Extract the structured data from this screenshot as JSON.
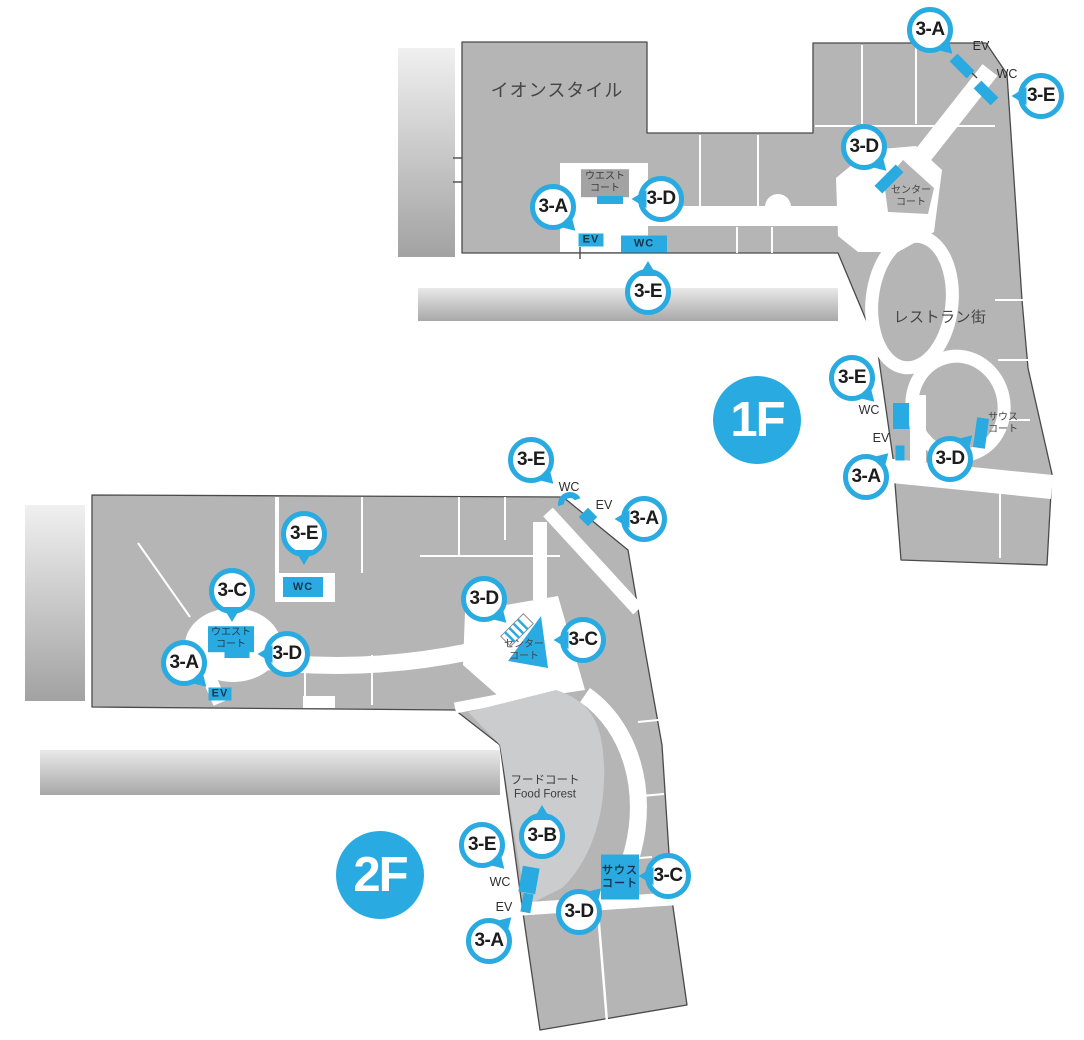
{
  "colors": {
    "accent": "#29abe2",
    "building": "#b5b5b6",
    "building_light": "#cacccd",
    "outline": "#4a4a4a"
  },
  "floors": [
    {
      "name": "1F",
      "badge": {
        "label": "1F"
      },
      "area_labels": [
        {
          "name": "aeon-style-label",
          "text": "イオンスタイル",
          "x": 557,
          "y": 91,
          "cls": "sz-big"
        },
        {
          "name": "west-court-label",
          "lines": [
            "ウエスト",
            "コート"
          ],
          "x": 605,
          "y": 183,
          "cls": "sz-small bg-gray"
        },
        {
          "name": "center-court-label",
          "lines": [
            "センター",
            "コート"
          ],
          "x": 911,
          "y": 197,
          "cls": "sz-small"
        },
        {
          "name": "restaurant-street-label",
          "text": "レストラン街",
          "x": 940,
          "y": 318,
          "cls": "sz-med"
        },
        {
          "name": "south-court-label",
          "lines": [
            "サウス",
            "コート"
          ],
          "x": 1003,
          "y": 424,
          "cls": "sz-small"
        }
      ],
      "markers": [
        {
          "label": "3-A",
          "x": 930,
          "y": 30,
          "tail": "br"
        },
        {
          "label": "3-E",
          "x": 1041,
          "y": 96,
          "tail": "l"
        },
        {
          "label": "3-D",
          "x": 864,
          "y": 147,
          "tail": "br"
        },
        {
          "label": "3-A",
          "x": 553,
          "y": 207,
          "tail": "br"
        },
        {
          "label": "3-D",
          "x": 661,
          "y": 199,
          "tail": "l"
        },
        {
          "label": "3-E",
          "x": 648,
          "y": 292,
          "tail": "t"
        },
        {
          "label": "3-E",
          "x": 852,
          "y": 378,
          "tail": "br"
        },
        {
          "label": "3-A",
          "x": 866,
          "y": 477,
          "tail": "tr"
        },
        {
          "label": "3-D",
          "x": 950,
          "y": 459,
          "tail": "tr"
        }
      ],
      "facilities": [
        {
          "name": "ev-label",
          "kind": "text",
          "label": "EV",
          "x": 981,
          "y": 46
        },
        {
          "name": "elevator-mark",
          "kind": "mark",
          "x": 962,
          "y": 66,
          "w": 24,
          "h": 11,
          "rot": 45
        },
        {
          "name": "wc-label",
          "kind": "text",
          "label": "WC",
          "x": 1007,
          "y": 74
        },
        {
          "name": "toilet-mark",
          "kind": "mark",
          "x": 986,
          "y": 93,
          "w": 24,
          "h": 11,
          "rot": 45
        },
        {
          "name": "escalator-mark",
          "kind": "mark",
          "x": 889,
          "y": 179,
          "w": 30,
          "h": 11,
          "rot": -45
        },
        {
          "name": "escalator-mark",
          "kind": "mark",
          "x": 610,
          "y": 200,
          "w": 26,
          "h": 8,
          "rot": 0
        },
        {
          "name": "ev-sign",
          "kind": "box",
          "label": "EV",
          "x": 591,
          "y": 240,
          "w": 25,
          "h": 13
        },
        {
          "name": "wc-sign",
          "kind": "box",
          "label": "WC",
          "x": 644,
          "y": 244,
          "w": 46,
          "h": 17
        },
        {
          "name": "wc-label",
          "kind": "text",
          "label": "WC",
          "x": 869,
          "y": 410
        },
        {
          "name": "toilet-mark",
          "kind": "mark",
          "x": 901,
          "y": 416,
          "w": 16,
          "h": 26,
          "rot": 0
        },
        {
          "name": "ev-label",
          "kind": "text",
          "label": "EV",
          "x": 881,
          "y": 438
        },
        {
          "name": "elevator-mark",
          "kind": "mark",
          "x": 900,
          "y": 453,
          "w": 9,
          "h": 15,
          "rot": 0
        },
        {
          "name": "escalator-mark",
          "kind": "mark",
          "x": 981,
          "y": 433,
          "w": 12,
          "h": 30,
          "rot": 8
        }
      ]
    },
    {
      "name": "2F",
      "badge": {
        "label": "2F"
      },
      "area_labels": [
        {
          "name": "west-court-label",
          "lines": [
            "ウエスト",
            "コート"
          ],
          "x": 231,
          "y": 639,
          "cls": "sz-small bg-blue"
        },
        {
          "name": "center-court-label",
          "lines": [
            "センター",
            "コート"
          ],
          "x": 524,
          "y": 651,
          "cls": "sz-small"
        },
        {
          "name": "food-court-label",
          "lines": [
            "フードコート",
            "Food Forest"
          ],
          "x": 545,
          "y": 788,
          "cls": "sz-ff"
        }
      ],
      "markers": [
        {
          "label": "3-E",
          "x": 531,
          "y": 460,
          "tail": "br"
        },
        {
          "label": "3-A",
          "x": 644,
          "y": 519,
          "tail": "l"
        },
        {
          "label": "3-E",
          "x": 304,
          "y": 534,
          "tail": "b"
        },
        {
          "label": "3-C",
          "x": 232,
          "y": 591,
          "tail": "b"
        },
        {
          "label": "3-D",
          "x": 287,
          "y": 654,
          "tail": "l"
        },
        {
          "label": "3-A",
          "x": 184,
          "y": 663,
          "tail": "br"
        },
        {
          "label": "3-D",
          "x": 484,
          "y": 599,
          "tail": "br"
        },
        {
          "label": "3-C",
          "x": 583,
          "y": 640,
          "tail": "l"
        },
        {
          "label": "3-B",
          "x": 542,
          "y": 836,
          "tail": "t"
        },
        {
          "label": "3-E",
          "x": 482,
          "y": 845,
          "tail": "br"
        },
        {
          "label": "3-A",
          "x": 489,
          "y": 941,
          "tail": "tr"
        },
        {
          "label": "3-D",
          "x": 579,
          "y": 912,
          "tail": "tr"
        },
        {
          "label": "3-C",
          "x": 668,
          "y": 876,
          "tail": "l"
        }
      ],
      "facilities": [
        {
          "name": "wc-label",
          "kind": "text",
          "label": "WC",
          "x": 569,
          "y": 487
        },
        {
          "name": "toilet-mark",
          "kind": "arc",
          "x": 570,
          "y": 504,
          "w": 24,
          "h": 24,
          "rot": -20
        },
        {
          "name": "ev-label",
          "kind": "text",
          "label": "EV",
          "x": 604,
          "y": 505
        },
        {
          "name": "elevator-mark",
          "kind": "mark",
          "x": 588,
          "y": 517,
          "w": 13,
          "h": 13,
          "rot": 45
        },
        {
          "name": "wc-sign",
          "kind": "box",
          "label": "WC",
          "x": 303,
          "y": 587,
          "w": 40,
          "h": 20
        },
        {
          "name": "escalator-mark",
          "kind": "mark",
          "x": 237,
          "y": 654,
          "w": 25,
          "h": 8,
          "rot": 0
        },
        {
          "name": "ev-sign",
          "kind": "box",
          "label": "EV",
          "x": 220,
          "y": 694,
          "w": 23,
          "h": 13
        },
        {
          "name": "south-court-sign",
          "kind": "box",
          "lines": [
            "サウス",
            "コート"
          ],
          "x": 620,
          "y": 877,
          "w": 38,
          "h": 45
        },
        {
          "name": "wc-label",
          "kind": "text",
          "label": "WC",
          "x": 500,
          "y": 882
        },
        {
          "name": "toilet-mark",
          "kind": "mark",
          "x": 529,
          "y": 880,
          "w": 17,
          "h": 26,
          "rot": 10
        },
        {
          "name": "ev-label",
          "kind": "text",
          "label": "EV",
          "x": 504,
          "y": 907
        },
        {
          "name": "elevator-mark",
          "kind": "mark",
          "x": 527,
          "y": 903,
          "w": 10,
          "h": 19,
          "rot": 10
        }
      ]
    }
  ]
}
